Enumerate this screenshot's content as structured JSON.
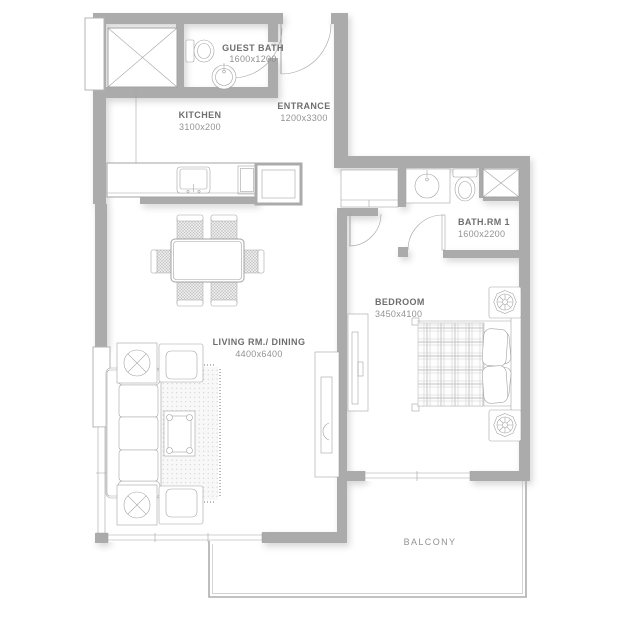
{
  "plan_title": "apartment-floor-plan",
  "colors": {
    "bg": "#ffffff",
    "wall": "#ababab",
    "line": "#a3a3a3",
    "line-light": "#b5b5b5",
    "label": "#6e6e6e",
    "dim": "#929292"
  },
  "rooms": [
    {
      "name": "GUEST BATH",
      "dims": "1600x1200"
    },
    {
      "name": "KITCHEN",
      "dims": "3100x200"
    },
    {
      "name": "ENTRANCE",
      "dims": "1200x3300"
    },
    {
      "name": "BATH.RM 1",
      "dims": "1600x2200"
    },
    {
      "name": "BEDROOM",
      "dims": "3450x4100"
    },
    {
      "name": "LIVING RM./ DINING",
      "dims": "4400x6400"
    },
    {
      "name": "BALCONY",
      "dims": ""
    }
  ]
}
